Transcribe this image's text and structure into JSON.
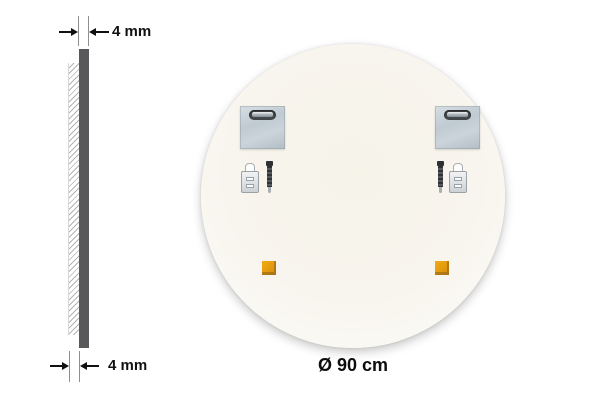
{
  "diagram": {
    "diameter_label": "Ø 90 cm",
    "side_profile": {
      "top_thickness_label": "4 mm",
      "bottom_thickness_label": "4 mm"
    },
    "hardware": {
      "hanging_brackets": 2,
      "wall_plugs": 2,
      "screws": 2,
      "adhesive_pads": 2
    },
    "colors": {
      "background": "#ffffff",
      "mirror_back_fill": "#f8f5ee",
      "profile_bar": "#58585a",
      "bracket_metal": "#c2ccd4",
      "keyhole_slot": "#45484b",
      "adhesive_pad": "#e39a10",
      "annotation_text": "#111111"
    }
  }
}
